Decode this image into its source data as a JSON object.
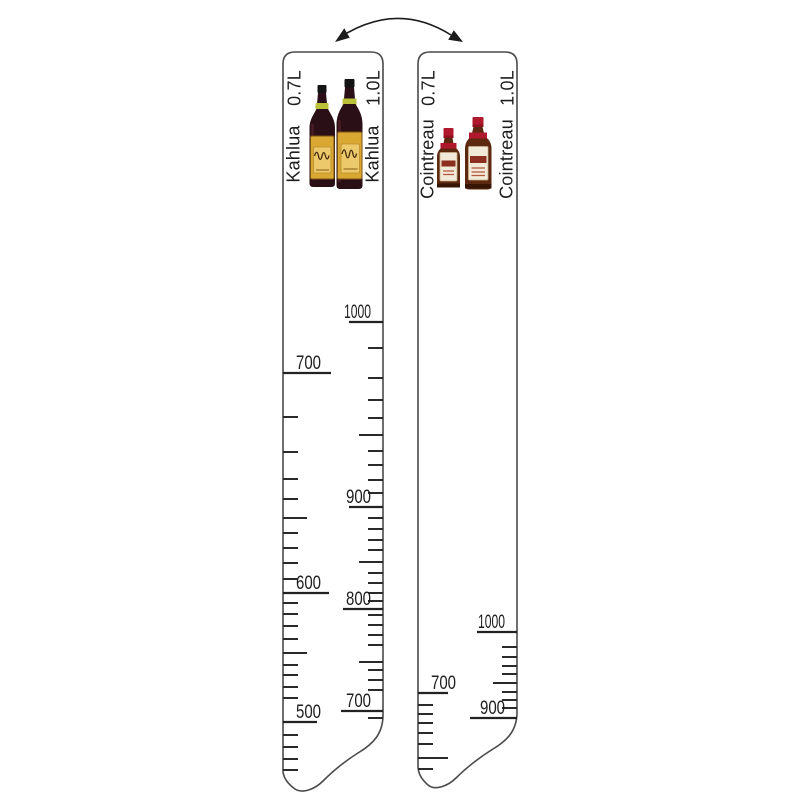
{
  "page": {
    "background": "#ffffff",
    "ink": "#262626"
  },
  "flip_arrow": {
    "icon": "curved-double-headed-arrow"
  },
  "strips": [
    {
      "id": "kahlua",
      "brand": "Kahlua",
      "side_labels": {
        "left_size": "0.7L",
        "left_brand": "Kahlua",
        "right_size": "1.0L",
        "right_brand": "Kahlua"
      },
      "bottles": [
        {
          "name": "kahlua-bottle-small",
          "size": "0.7L"
        },
        {
          "name": "kahlua-bottle-large",
          "size": "1.0L"
        }
      ],
      "bottle_style": {
        "glass": "#2a1016",
        "cap": "#141414",
        "neck_band": "#bcc13a",
        "label_bg": "#d9a833",
        "label_inner": "#ecc96a",
        "script": "#43270a"
      },
      "scales": {
        "left": {
          "unit": "0.7L",
          "labels": [
            {
              "text": "700",
              "y": 373,
              "len": 48
            },
            {
              "text": "600",
              "y": 593,
              "len": 46
            },
            {
              "text": "500",
              "y": 722,
              "len": 34
            }
          ],
          "ticks": [
            [
              417,
              "s"
            ],
            [
              452,
              "s"
            ],
            [
              479,
              "s"
            ],
            [
              499,
              "s"
            ],
            [
              518,
              "m"
            ],
            [
              533,
              "s"
            ],
            [
              548,
              "s"
            ],
            [
              563,
              "s"
            ],
            [
              579,
              "s"
            ],
            [
              603,
              "s"
            ],
            [
              614,
              "s"
            ],
            [
              626,
              "s"
            ],
            [
              639,
              "s"
            ],
            [
              653,
              "m"
            ],
            [
              665,
              "s"
            ],
            [
              675,
              "s"
            ],
            [
              687,
              "s"
            ],
            [
              698,
              "s"
            ],
            [
              735,
              "s"
            ],
            [
              747,
              "s"
            ],
            [
              759,
              "s"
            ],
            [
              770,
              "s"
            ]
          ]
        },
        "right": {
          "unit": "1.0L",
          "labels": [
            {
              "text": "1000",
              "y": 322,
              "len": 34
            },
            {
              "text": "900",
              "y": 507,
              "len": 34
            },
            {
              "text": "800",
              "y": 609,
              "len": 40
            },
            {
              "text": "700",
              "y": 711,
              "len": 42
            }
          ],
          "ticks": [
            [
              348,
              "s"
            ],
            [
              378,
              "s"
            ],
            [
              400,
              "s"
            ],
            [
              418,
              "s"
            ],
            [
              435,
              "m"
            ],
            [
              451,
              "s"
            ],
            [
              465,
              "s"
            ],
            [
              480,
              "s"
            ],
            [
              493,
              "s"
            ],
            [
              518,
              "s"
            ],
            [
              529,
              "s"
            ],
            [
              540,
              "s"
            ],
            [
              550,
              "s"
            ],
            [
              562,
              "m"
            ],
            [
              573,
              "s"
            ],
            [
              583,
              "s"
            ],
            [
              593,
              "s"
            ],
            [
              601,
              "s"
            ],
            [
              615,
              "s"
            ],
            [
              625,
              "s"
            ],
            [
              635,
              "s"
            ],
            [
              645,
              "s"
            ],
            [
              662,
              "m"
            ],
            [
              670,
              "s"
            ],
            [
              680,
              "s"
            ],
            [
              690,
              "s"
            ],
            [
              718,
              "s"
            ]
          ]
        }
      }
    },
    {
      "id": "cointreau",
      "brand": "Cointreau",
      "side_labels": {
        "left_size": "0.7L",
        "left_brand": "Cointreau",
        "right_size": "1.0L",
        "right_brand": "Cointreau"
      },
      "bottles": [
        {
          "name": "cointreau-bottle-small",
          "size": "0.7L"
        },
        {
          "name": "cointreau-bottle-large",
          "size": "1.0L"
        }
      ],
      "bottle_style": {
        "glass": "#5c2810",
        "cap": "#b0182e",
        "label_bg": "#f2ead8",
        "label_midband": "#8c2f20"
      },
      "scales": {
        "left": {
          "unit": "0.7L",
          "labels": [
            {
              "text": "700",
              "y": 693,
              "len": 30
            }
          ],
          "ticks": [
            [
              705,
              "s"
            ],
            [
              714,
              "s"
            ],
            [
              723,
              "s"
            ],
            [
              733,
              "s"
            ],
            [
              744,
              "s"
            ],
            [
              758,
              "l"
            ],
            [
              769,
              "s"
            ]
          ]
        },
        "right": {
          "unit": "1.0L",
          "labels": [
            {
              "text": "1000",
              "y": 632,
              "len": 40
            },
            {
              "text": "900",
              "y": 718,
              "len": 47
            }
          ],
          "ticks": [
            [
              647,
              "s"
            ],
            [
              657,
              "s"
            ],
            [
              666,
              "s"
            ],
            [
              674,
              "s"
            ],
            [
              683,
              "m"
            ],
            [
              692,
              "s"
            ],
            [
              700,
              "s"
            ],
            [
              708,
              "s"
            ]
          ]
        }
      }
    }
  ]
}
